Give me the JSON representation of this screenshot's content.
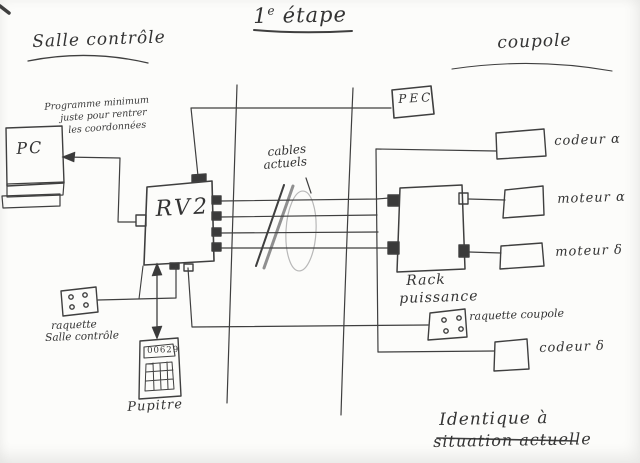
{
  "title": {
    "base": "1",
    "sup": "e",
    "rest": "étape"
  },
  "zones": {
    "salle_controle": "Salle contrôle",
    "coupole": "coupole"
  },
  "notes": {
    "programme": {
      "line1": "Programme minimum",
      "line2": "juste pour rentrer",
      "line3": "les coordonnées"
    },
    "cables": {
      "line1": "cables",
      "line2": "actuels"
    },
    "identique": {
      "line1": "Identique à",
      "line2": "situation actuelle"
    }
  },
  "nodes": {
    "pc": {
      "label": "PC"
    },
    "rv2": {
      "label": "RV2"
    },
    "pec": {
      "label": "PEC"
    },
    "rack": {
      "line1": "Rack",
      "line2": "puissance"
    },
    "codeur_alpha": {
      "label": "codeur α"
    },
    "moteur_alpha": {
      "label": "moteur α"
    },
    "moteur_delta": {
      "label": "moteur δ"
    },
    "codeur_delta": {
      "label": "codeur δ"
    },
    "raquette_salle": {
      "line1": "raquette",
      "line2": "Salle contrôle"
    },
    "raquette_coupole": {
      "label": "raquette coupole"
    },
    "pupitre": {
      "label": "Pupitre",
      "display": "00629"
    }
  },
  "colors": {
    "ink": "#3f3f3f",
    "pencil": "#b8b8b8",
    "paper": "#fcfcfa"
  }
}
